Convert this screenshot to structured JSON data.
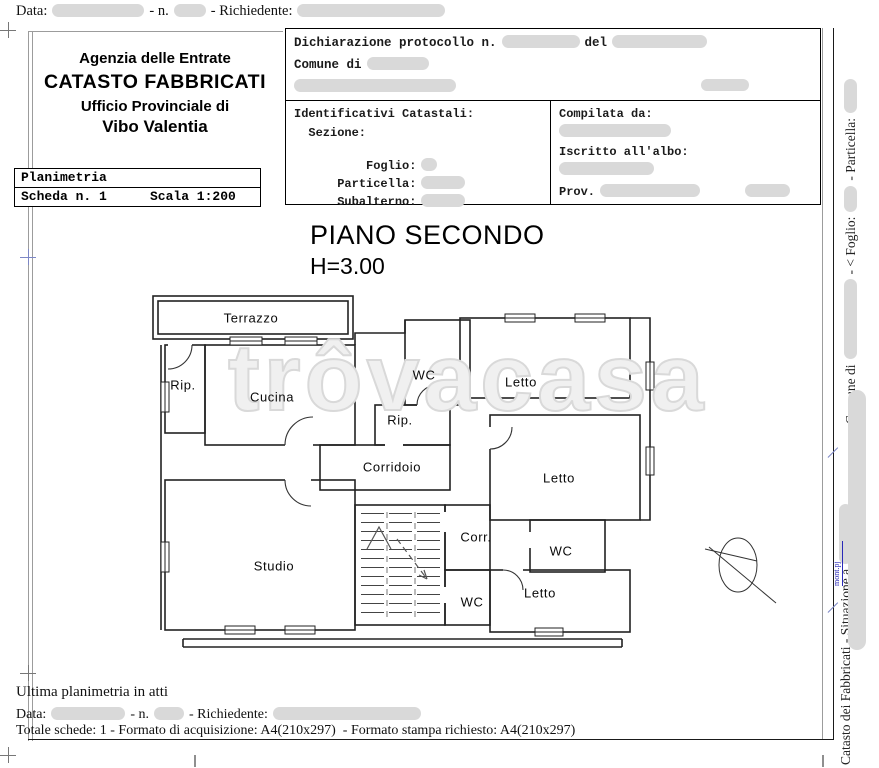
{
  "header": {
    "top_line": {
      "data_label": "Data:",
      "n_label": "- n.",
      "richiedente_label": "- Richiedente:"
    },
    "agency": {
      "line1": "Agenzia delle Entrate",
      "line2": "CATASTO FABBRICATI",
      "line3": "Ufficio Provinciale di",
      "line4": "Vibo Valentia"
    },
    "planimetria": {
      "title": "Planimetria",
      "scheda": "Scheda n. 1",
      "scala": "Scala 1:200"
    },
    "dichiarazione": {
      "protocollo": "Dichiarazione protocollo n.",
      "del": "del",
      "comune": "Comune di"
    },
    "identificativi": {
      "title": "Identificativi Catastali:",
      "sezione": "  Sezione:",
      "foglio": "    Foglio:",
      "particella": "Particella:",
      "subalterno": "Subalterno:"
    },
    "compilata": {
      "title": "Compilata da:",
      "iscritto": "Iscritto all'albo:",
      "prov": "Prov."
    }
  },
  "plan": {
    "title": "PIANO SECONDO",
    "height_label": "H=3.00",
    "watermark": "trôvacasa",
    "rooms": {
      "terrazzo": "Terrazzo",
      "rip_left": "Rip.",
      "cucina": "Cucina",
      "wc_top": "WC",
      "letto_top_right": "Letto",
      "rip_center": "Rip.",
      "corridoio": "Corridoio",
      "letto_right": "Letto",
      "corr": "Corr.",
      "wc_right": "WC",
      "studio": "Studio",
      "wc_bottom": "WC",
      "letto_bottom": "Letto"
    }
  },
  "margin_right": {
    "comune": "- Comune di",
    "foglio": "- < Foglio:",
    "particella": "- Particella:",
    "catasto": "Catasto dei Fabbricati - Situazione a",
    "blue_note": "mont.pj"
  },
  "footer": {
    "ultima": "Ultima planimetria in atti",
    "data_label": "Data:",
    "n_label": "- n.",
    "richiedente_label": "- Richiedente:",
    "totale": "Totale schede: 1 - Formato di acquisizione: A4(210x297)  - Formato stampa richiesto: A4(210x297)"
  }
}
